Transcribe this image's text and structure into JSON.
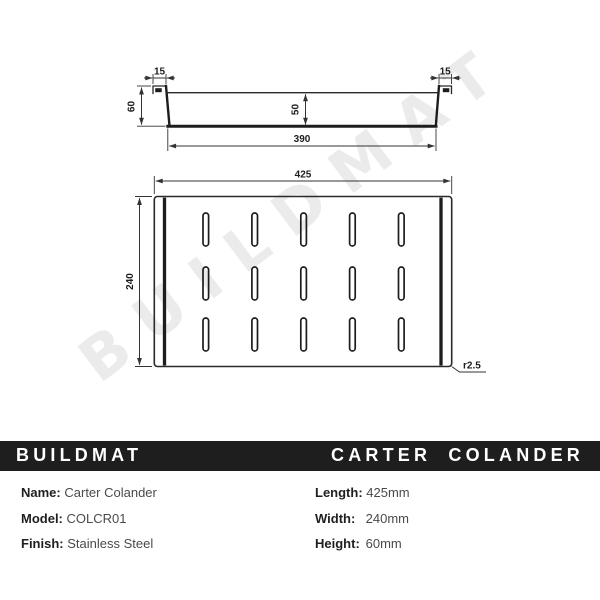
{
  "watermark": "BUILDMAT",
  "brand_bar": {
    "brand": "BUILDMAT",
    "product": "CARTER COLANDER",
    "bg_color": "#1e1e1e",
    "text_color": "#ffffff"
  },
  "side_view": {
    "dim_flange_left": "15",
    "dim_flange_right": "15",
    "dim_height": "60",
    "dim_depth": "50",
    "dim_base": "390"
  },
  "top_view": {
    "dim_length": "425",
    "dim_width": "240",
    "dim_radius": "r2.5",
    "slot_rows": 3,
    "slot_cols": 5
  },
  "specs": {
    "left": [
      {
        "label": "Name:",
        "value": "Carter Colander"
      },
      {
        "label": "Model:",
        "value": "COLCR01"
      },
      {
        "label": "Finish:",
        "value": "Stainless Steel"
      }
    ],
    "right": [
      {
        "label": "Length:",
        "value": "425mm"
      },
      {
        "label": "Width:",
        "value": "240mm"
      },
      {
        "label": "Height:",
        "value": "60mm"
      }
    ]
  },
  "drawing_colors": {
    "line": "#2a2a2a",
    "watermark": "#ebebeb"
  }
}
